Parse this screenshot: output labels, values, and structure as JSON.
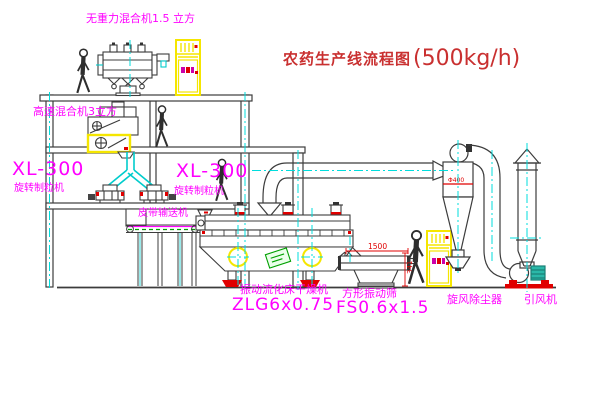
{
  "title": {
    "cn": "农药生产线流程图",
    "capacity": "(500kg/h)"
  },
  "labels": {
    "gravity_mixer": "无重力混合机1.5 立方",
    "high_speed_mixer": "高速混合机3立方",
    "xl_left_model": "XL-300",
    "xl_left_name": "旋转制粒机",
    "xl_right_model": "XL-300",
    "xl_right_name": "旋转制粒机",
    "belt_conveyor": "皮带输送机",
    "dryer_name": "振动流化床干燥机",
    "dryer_model": "ZLG6x0.75",
    "screen_name": "方形振动筛",
    "screen_model": "FS0.6x1.5",
    "cyclone": "旋风除尘器",
    "fan": "引风机"
  },
  "dimensions": {
    "screen_width": "1500",
    "screen_height": "341",
    "cyclone_dia": "Φ400"
  },
  "colors": {
    "label_magenta": "#ff00ff",
    "title_red": "#c93030",
    "machine_yellow": "#ffff00",
    "centerline_cyan": "#00dddd",
    "line_dark": "#3c3c3c",
    "accent_red": "#e00000",
    "conveyor_green": "#00a000",
    "motor_teal": "#2ab8a8"
  }
}
